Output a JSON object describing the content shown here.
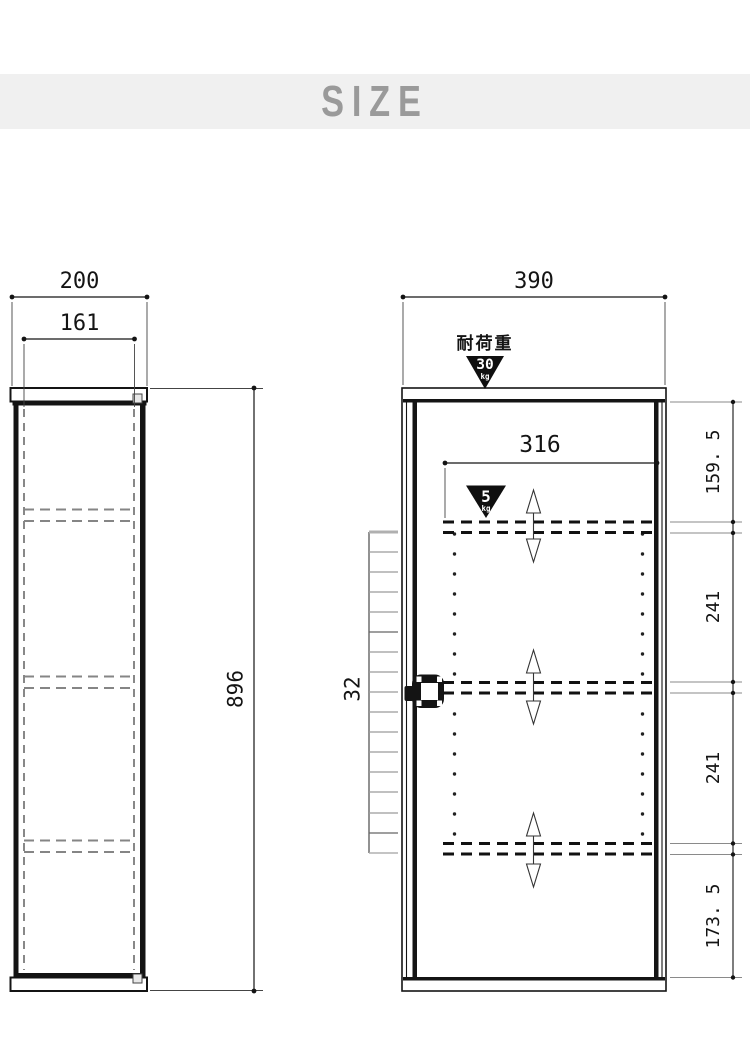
{
  "title": "SIZE",
  "left_view": {
    "outer_width": "200",
    "inner_width": "161",
    "height": "896"
  },
  "right_view": {
    "outer_width": "390",
    "inner_width": "316",
    "hole_pitch": "32",
    "load": {
      "label": "耐荷重",
      "value": "30",
      "unit": "kg"
    },
    "shelf_load": {
      "value": "5",
      "unit": "kg"
    },
    "side_dims": [
      "159. 5",
      "241",
      "241",
      "173. 5"
    ]
  },
  "colors": {
    "banner_bg": "#f0f0f0",
    "banner_text": "#9a9a9a",
    "line": "#141414",
    "triangle": "#0f0f0f"
  }
}
